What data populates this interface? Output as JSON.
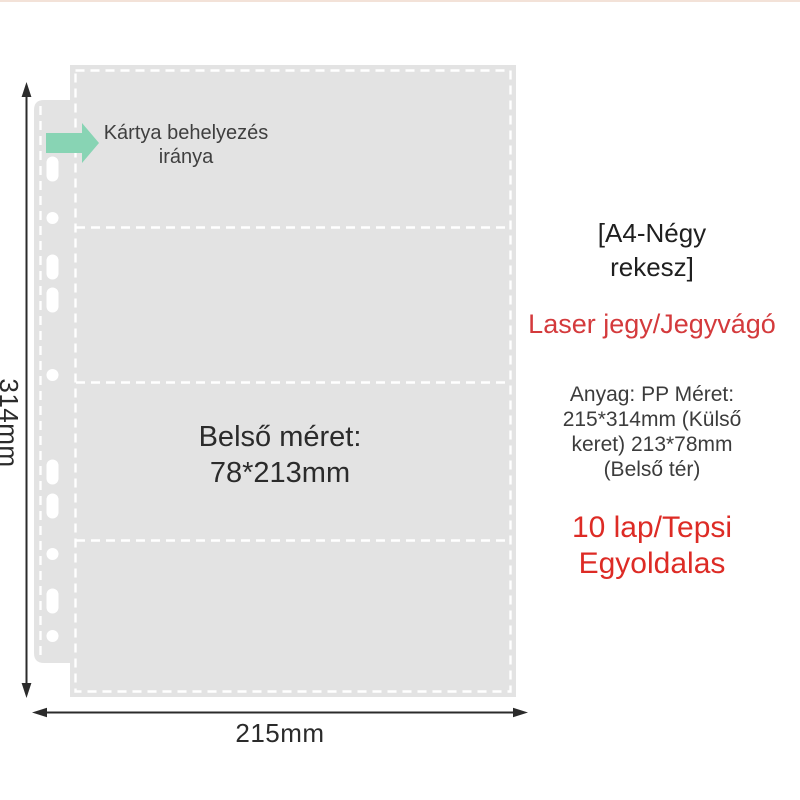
{
  "colors": {
    "sheet_fill": "#e3e3e3",
    "seam_white": "#ffffff",
    "arrow_accent": "#88d4b4",
    "dimension_line": "#2b2b2b",
    "subtitle_red": "#d43a3c",
    "quantity_red": "#dd2b25",
    "top_strip": "#f3e2d8"
  },
  "diagram": {
    "insertion_label": {
      "line1": "Kártya behelyezés",
      "line2": "iránya"
    },
    "inner_size_label": {
      "line1": "Belső méret:",
      "line2": "78*213mm"
    },
    "height_dimension": "314mm",
    "width_dimension": "215mm"
  },
  "info_panel": {
    "title": {
      "line1": "[A4-Négy",
      "line2": "rekesz]"
    },
    "subtitle": "Laser jegy/Jegyvágó",
    "specs": {
      "line1": "Anyag: PP Méret:",
      "line2": "215*314mm (Külső",
      "line3": "keret) 213*78mm",
      "line4": "(Belső tér)"
    },
    "quantity": {
      "line1": "10 lap/Tepsi",
      "line2": "Egyoldalas"
    }
  }
}
